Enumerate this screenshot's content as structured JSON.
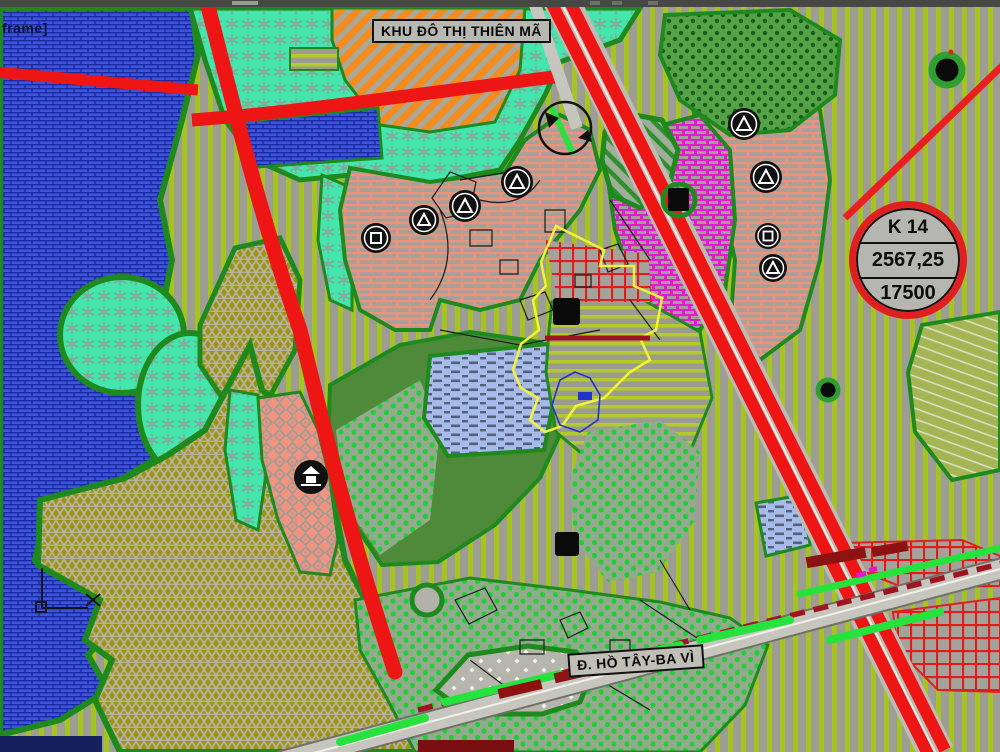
{
  "viewport": {
    "corner_text": "frame]"
  },
  "map": {
    "area_label": "KHU ĐÔ THỊ THIÊN MÃ",
    "road_label": "Đ. HỒ TÂY-BA VÌ"
  },
  "badge": {
    "code": "K 14",
    "value_top": "2567,25",
    "value_bottom": "17500"
  },
  "icons": [
    "utility-circle-triangle-icon",
    "utility-circle-square-icon",
    "pagoda-site-icon",
    "building-block-icon",
    "tree-icon",
    "roundabout-icon",
    "ucs-axis-icon",
    "parcel-badge"
  ],
  "palette": {
    "water_blue": "#3d55de",
    "teal_zone": "#43e7ad",
    "olive_zone": "#a0930f",
    "salmon_brick": "#f0917a",
    "magenta_zone": "#e818d2",
    "orange_zone": "#f28c1f",
    "stripe_green": "#a6c41e",
    "dot_green": "#1fce39",
    "road_red": "#ee1515",
    "boundary_green": "#1e8a1e",
    "boundary_yellow": "#f2f238",
    "rail_crimson": "#a01421",
    "tree_bright_green": "#25e23d",
    "road_gray": "#c6c6be",
    "badge_ring_red": "#e02020"
  }
}
